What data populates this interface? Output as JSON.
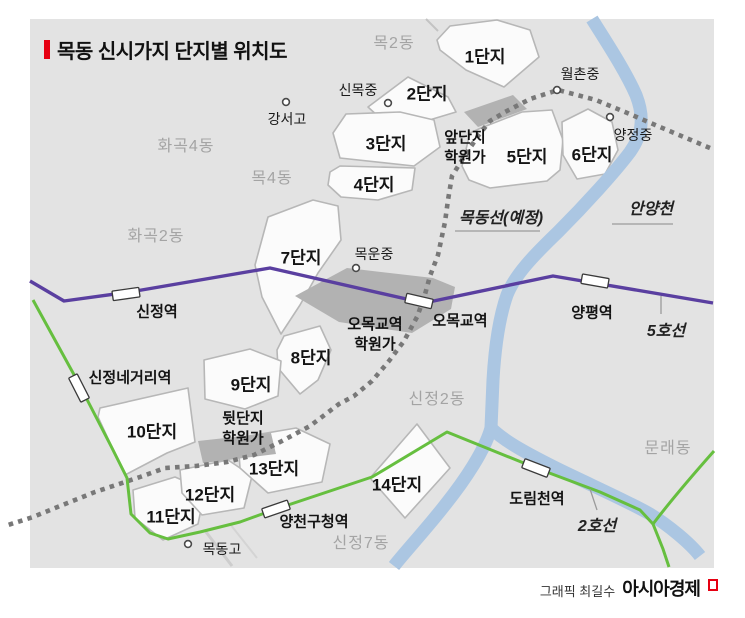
{
  "title": "목동 신시가지 단지별 위치도",
  "districts": {
    "mok2": "목2동",
    "hwagok4": "화곡4동",
    "mok4": "목4동",
    "hwagok2": "화곡2동",
    "sinjeong2": "신정2동",
    "sinjeong7": "신정7동",
    "mullae": "문래동"
  },
  "complexes": {
    "c1": "1단지",
    "c2": "2단지",
    "c3": "3단지",
    "c4": "4단지",
    "c5": "5단지",
    "c6": "6단지",
    "c7": "7단지",
    "c8": "8단지",
    "c9": "9단지",
    "c10": "10단지",
    "c11": "11단지",
    "c12": "12단지",
    "c13": "13단지",
    "c14": "14단지"
  },
  "academy_zones": {
    "front": {
      "line1": "앞단지",
      "line2": "학원가"
    },
    "omokgyo": {
      "line1": "오목교역",
      "line2": "학원가"
    },
    "back": {
      "line1": "뒷단지",
      "line2": "학원가"
    }
  },
  "schools": {
    "gangseo": "강서고",
    "sinmok": "신목중",
    "wolchon": "월촌중",
    "yangjeong": "양정중",
    "mokwoon": "목운중",
    "mokdong_high": "목동고"
  },
  "stations": {
    "sinjeong": "신정역",
    "sinjeong_crossroads": "신정네거리역",
    "omokgyo": "오목교역",
    "yangpyeong": "양평역",
    "yangcheon_office": "양천구청역",
    "dorimcheon": "도림천역"
  },
  "transit_lines": {
    "line5": "5호선",
    "line2": "2호선",
    "mokdong_line": "목동선(예정)"
  },
  "river": {
    "name": "안양천"
  },
  "credit": {
    "byline": "그래픽 최길수",
    "brand": "아시아경제"
  },
  "colors": {
    "accent_red": "#e60012",
    "line5_purple": "#5a3fa0",
    "line2_green": "#66bf3f",
    "planned_line_gray": "#787878",
    "river_blue": "#abc6e2",
    "map_bg": "#e3e3e3",
    "complex_fill": "#fbfbfb",
    "academy_area": "#b2b2b2"
  }
}
